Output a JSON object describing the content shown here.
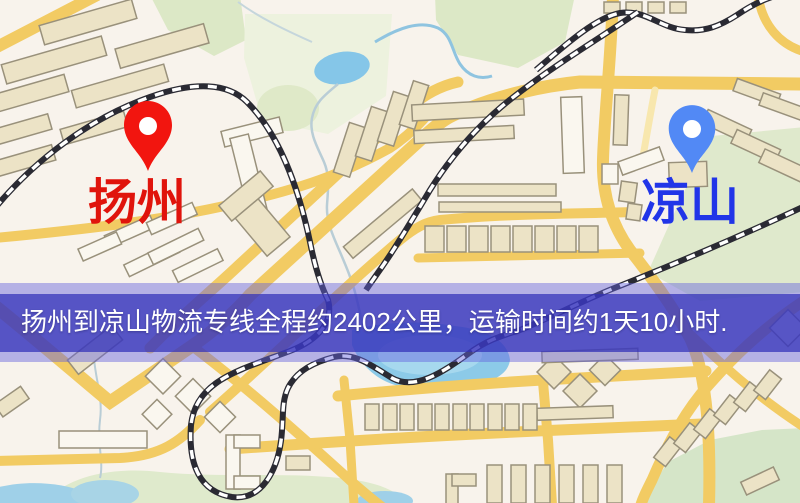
{
  "banner": {
    "text": "扬州到凉山物流专线全程约2402公里，运输时间约1天10小时.",
    "background_color": "#5a58cc",
    "text_color": "#ffffff"
  },
  "markers": [
    {
      "id": "yangzhou",
      "label": "扬州",
      "pin_color": "#f2150f",
      "label_color": "#e0140c"
    },
    {
      "id": "liangshan",
      "label": "凉山",
      "pin_color": "#5289f5",
      "label_color": "#2135e8"
    }
  ],
  "map_colors": {
    "background": "#f8f3ec",
    "road": "#f2cb63",
    "minor_road": "#f8e7ae",
    "water": "#8ccae8",
    "park_green": "#dce8c6",
    "building_tan": "#ece3c6",
    "building_white": "#faf7ef",
    "railway_dark": "#2a2a33"
  }
}
